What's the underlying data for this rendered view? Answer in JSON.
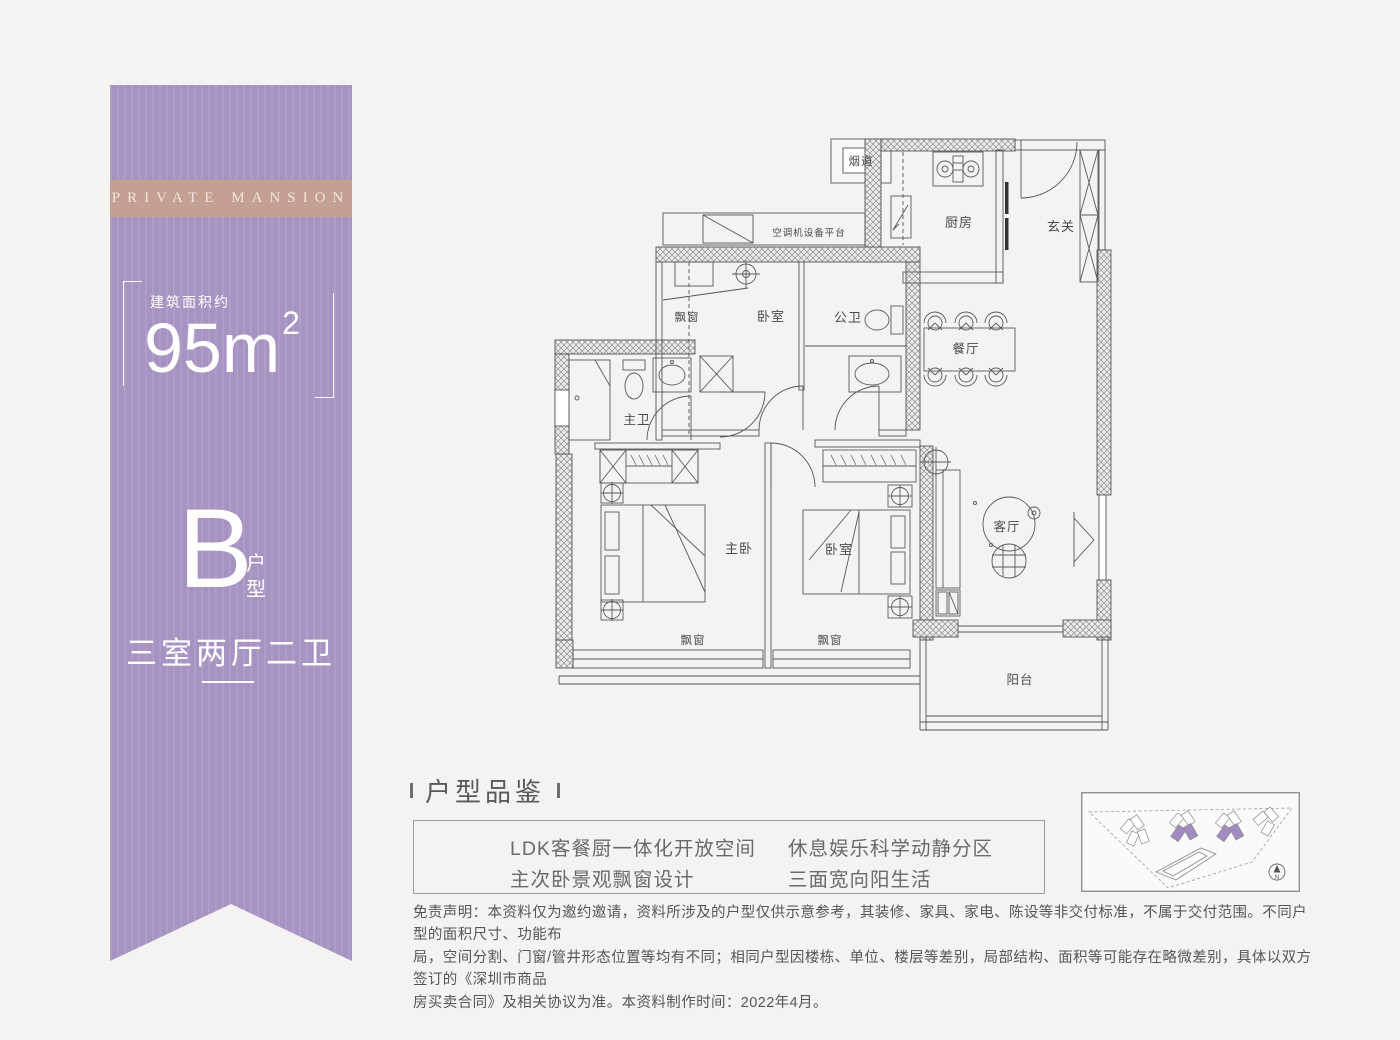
{
  "page": {
    "background": "#f4f3f1",
    "accent_purple": "#a793c2",
    "band_tan": "#c4a093"
  },
  "banner": {
    "band_text": "PRIVATE MANSION",
    "area_label": "建筑面积约",
    "area_value": "95m",
    "area_sup": "2",
    "type_letter": "B",
    "type_char1": "户",
    "type_char2": "型",
    "layout_text": "三室两厅二卫"
  },
  "floorplan": {
    "labels": {
      "flue": "烟道",
      "ac_platform": "空调机设备平台",
      "kitchen": "厨房",
      "foyer": "玄关",
      "bay_upper": "飘窗",
      "bedroom_upper": "卧室",
      "guest_bath": "公卫",
      "dining": "餐厅",
      "master_bath": "主卫",
      "master_bedroom": "主卧",
      "bedroom2": "卧室",
      "living": "客厅",
      "bay_master": "飘窗",
      "bay_bedroom2": "飘窗",
      "balcony": "阳台"
    }
  },
  "section": {
    "title": "户型品鉴",
    "features": [
      "LDK客餐厨一体化开放空间",
      "休息娱乐科学动静分区",
      "主次卧景观飘窗设计",
      "三面宽向阳生活"
    ]
  },
  "sitemap": {
    "north": "N",
    "highlight_color": "#a28bc2"
  },
  "disclaimer": {
    "lines": [
      "免责声明：本资料仅为邀约邀请，资料所涉及的户型仅供示意参考，其装修、家具、家电、陈设等非交付标准，不属于交付范围。不同户型的面积尺寸、功能布",
      "局，空间分割、门窗/管井形态位置等均有不同；相同户型因楼栋、单位、楼层等差别，局部结构、面积等可能存在略微差别，具体以双方签订的《深圳市商品",
      "房买卖合同》及相关协议为准。本资料制作时间：2022年4月。"
    ]
  }
}
